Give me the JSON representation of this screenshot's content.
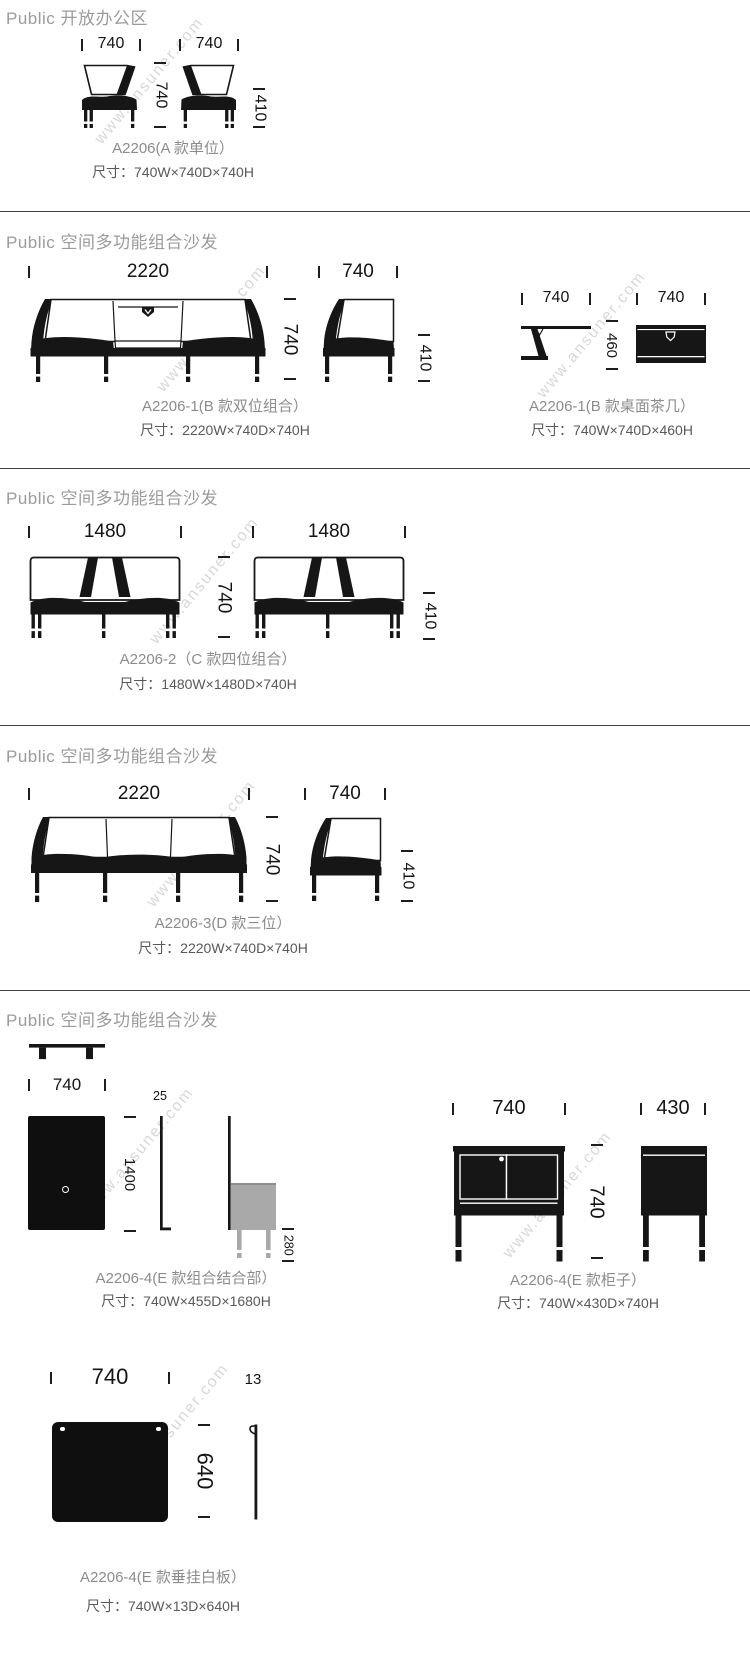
{
  "watermark": "www.ansuner.com",
  "colors": {
    "drawing_line": "#161616",
    "header_text": "#9b9b9b",
    "caption_text": "#8c8c8c",
    "size_text": "#595959",
    "watermark_text": "#d8d8d8",
    "panel_gray": "#a9a9a9"
  },
  "sections": {
    "s1": {
      "header": "Public 开放办公区",
      "dim_width_left": "740",
      "dim_width_right": "740",
      "dim_depth": "740",
      "dim_seat_height": "410",
      "caption": "A2206(A 款单位）",
      "size": "尺寸：740W×740D×740H"
    },
    "s2": {
      "header": "Public 空间多功能组合沙发",
      "sofa": {
        "dim_width": "2220",
        "dim_height": "740",
        "dim_side_width": "740",
        "dim_seat_height": "410",
        "caption": "A2206-1(B 款双位组合）",
        "size": "尺寸：2220W×740D×740H"
      },
      "tea_table": {
        "dim_side_width": "740",
        "dim_height": "460",
        "dim_front_width": "740",
        "caption": "A2206-1(B 款桌面茶几）",
        "size": "尺寸：740W×740D×460H"
      }
    },
    "s3": {
      "header": "Public 空间多功能组合沙发",
      "dim_width_left": "1480",
      "dim_width_right": "1480",
      "dim_height": "740",
      "dim_seat_height": "410",
      "caption": "A2206-2（C 款四位组合）",
      "size": "尺寸：1480W×1480D×740H"
    },
    "s4": {
      "header": "Public 空间多功能组合沙发",
      "dim_width": "2220",
      "dim_height": "740",
      "dim_side_width": "740",
      "dim_seat_height": "410",
      "caption": "A2206-3(D 款三位）",
      "size": "尺寸：2220W×740D×740H"
    },
    "s5": {
      "header": "Public 空间多功能组合沙发",
      "combo": {
        "dim_width": "740",
        "dim_thickness": "25",
        "dim_height": "1400",
        "dim_leg_height": "280",
        "caption": "A2206-4(E 款组合结合部）",
        "size": "尺寸：740W×455D×1680H"
      },
      "cabinet": {
        "dim_width": "740",
        "dim_height": "740",
        "dim_depth": "430",
        "caption": "A2206-4(E 款柜子）",
        "size": "尺寸：740W×430D×740H"
      },
      "whiteboard": {
        "dim_width": "740",
        "dim_thickness": "13",
        "dim_height": "640",
        "caption": "A2206-4(E 款垂挂白板）",
        "size": "尺寸：740W×13D×640H"
      }
    }
  }
}
